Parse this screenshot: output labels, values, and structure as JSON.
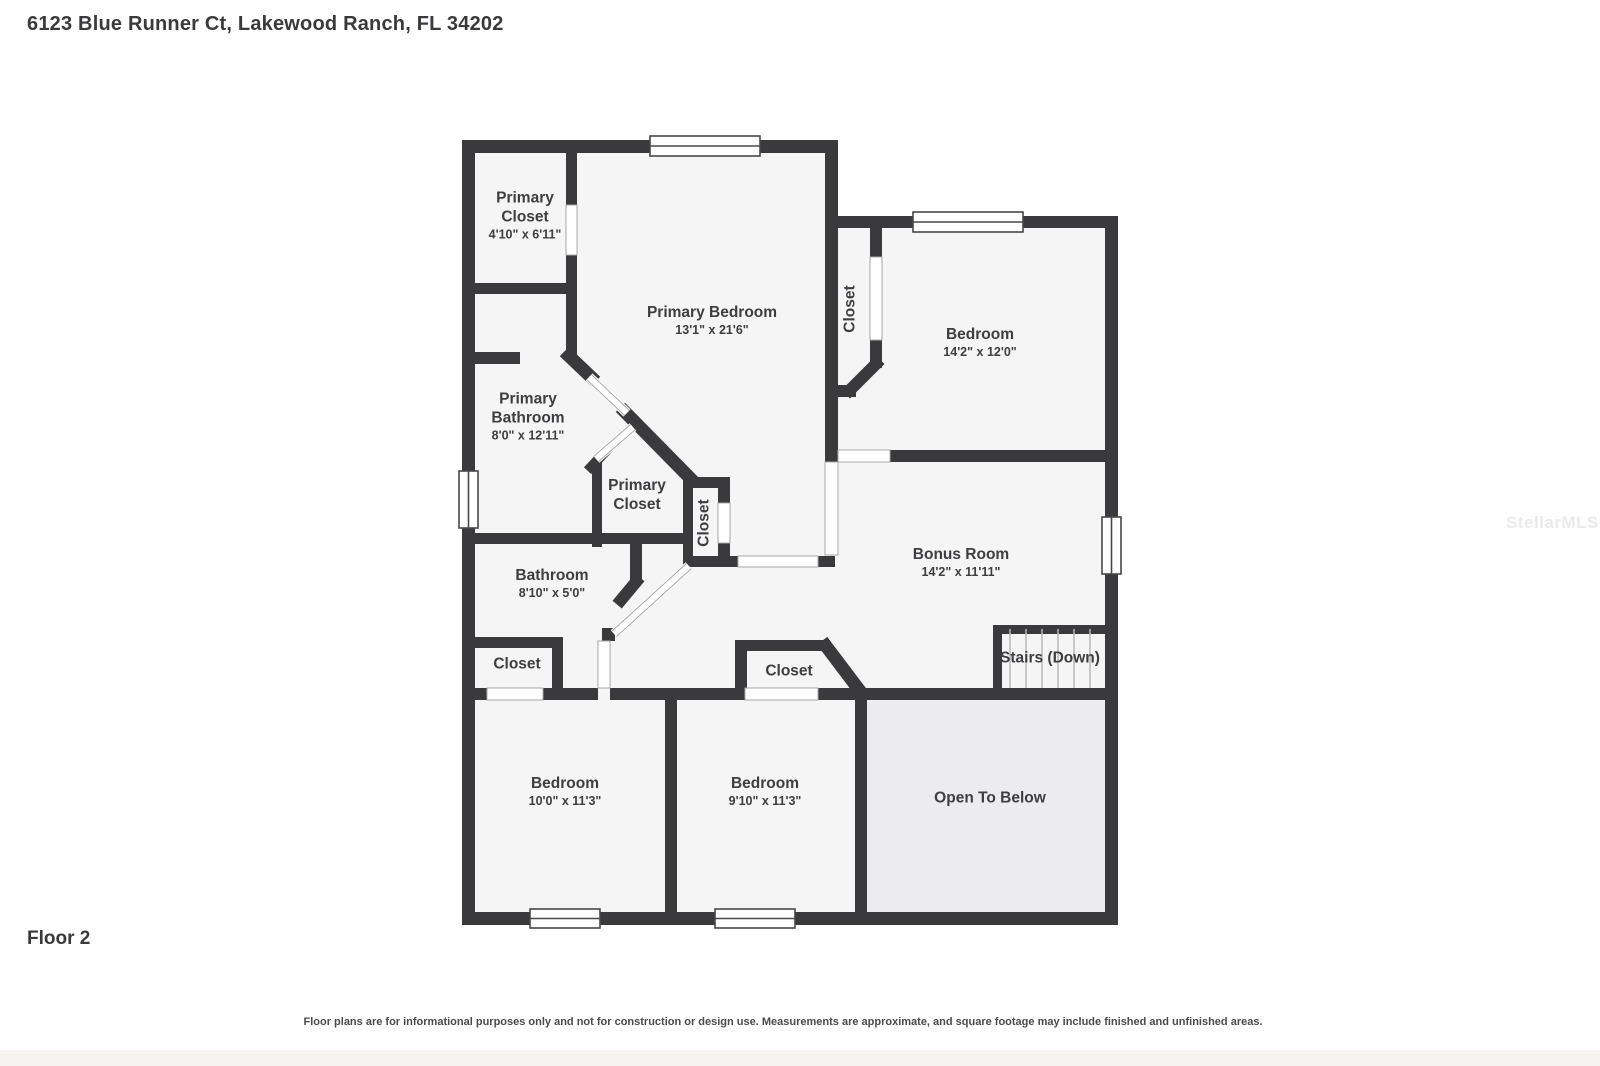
{
  "header": {
    "title": "6123 Blue Runner Ct, Lakewood Ranch, FL 34202"
  },
  "floor_label": "Floor 2",
  "watermark": "StellarMLS",
  "disclaimer": "Floor plans are for informational purposes only and not for construction or design use. Measurements are approximate, and square footage may include finished and unfinished areas.",
  "colors": {
    "wall": "#3a3a3c",
    "floor": "#f5f5f6",
    "open_to_below_floor": "#ececee",
    "label_text": "#3e3e40",
    "window_outline": "#48484b",
    "door_hairline": "#a8a8a8",
    "stair_tread": "#b8b8b8"
  },
  "rooms": [
    {
      "name": "Primary Closet",
      "dims": "4'10\" x 6'11\""
    },
    {
      "name": "Primary Bedroom",
      "dims": "13'1\" x 21'6\""
    },
    {
      "name": "Closet"
    },
    {
      "name": "Bedroom",
      "dims": "14'2\" x 12'0\""
    },
    {
      "name": "Primary Bathroom",
      "dims": "8'0\" x 12'11\""
    },
    {
      "name": "Primary Closet"
    },
    {
      "name": "Closet"
    },
    {
      "name": "Bonus Room",
      "dims": "14'2\" x 11'11\""
    },
    {
      "name": "Bathroom",
      "dims": "8'10\" x 5'0\""
    },
    {
      "name": "Closet"
    },
    {
      "name": "Closet"
    },
    {
      "name": "Stairs (Down)"
    },
    {
      "name": "Bedroom",
      "dims": "10'0\" x 11'3\""
    },
    {
      "name": "Bedroom",
      "dims": "9'10\" x 11'3\""
    },
    {
      "name": "Open To Below"
    }
  ]
}
